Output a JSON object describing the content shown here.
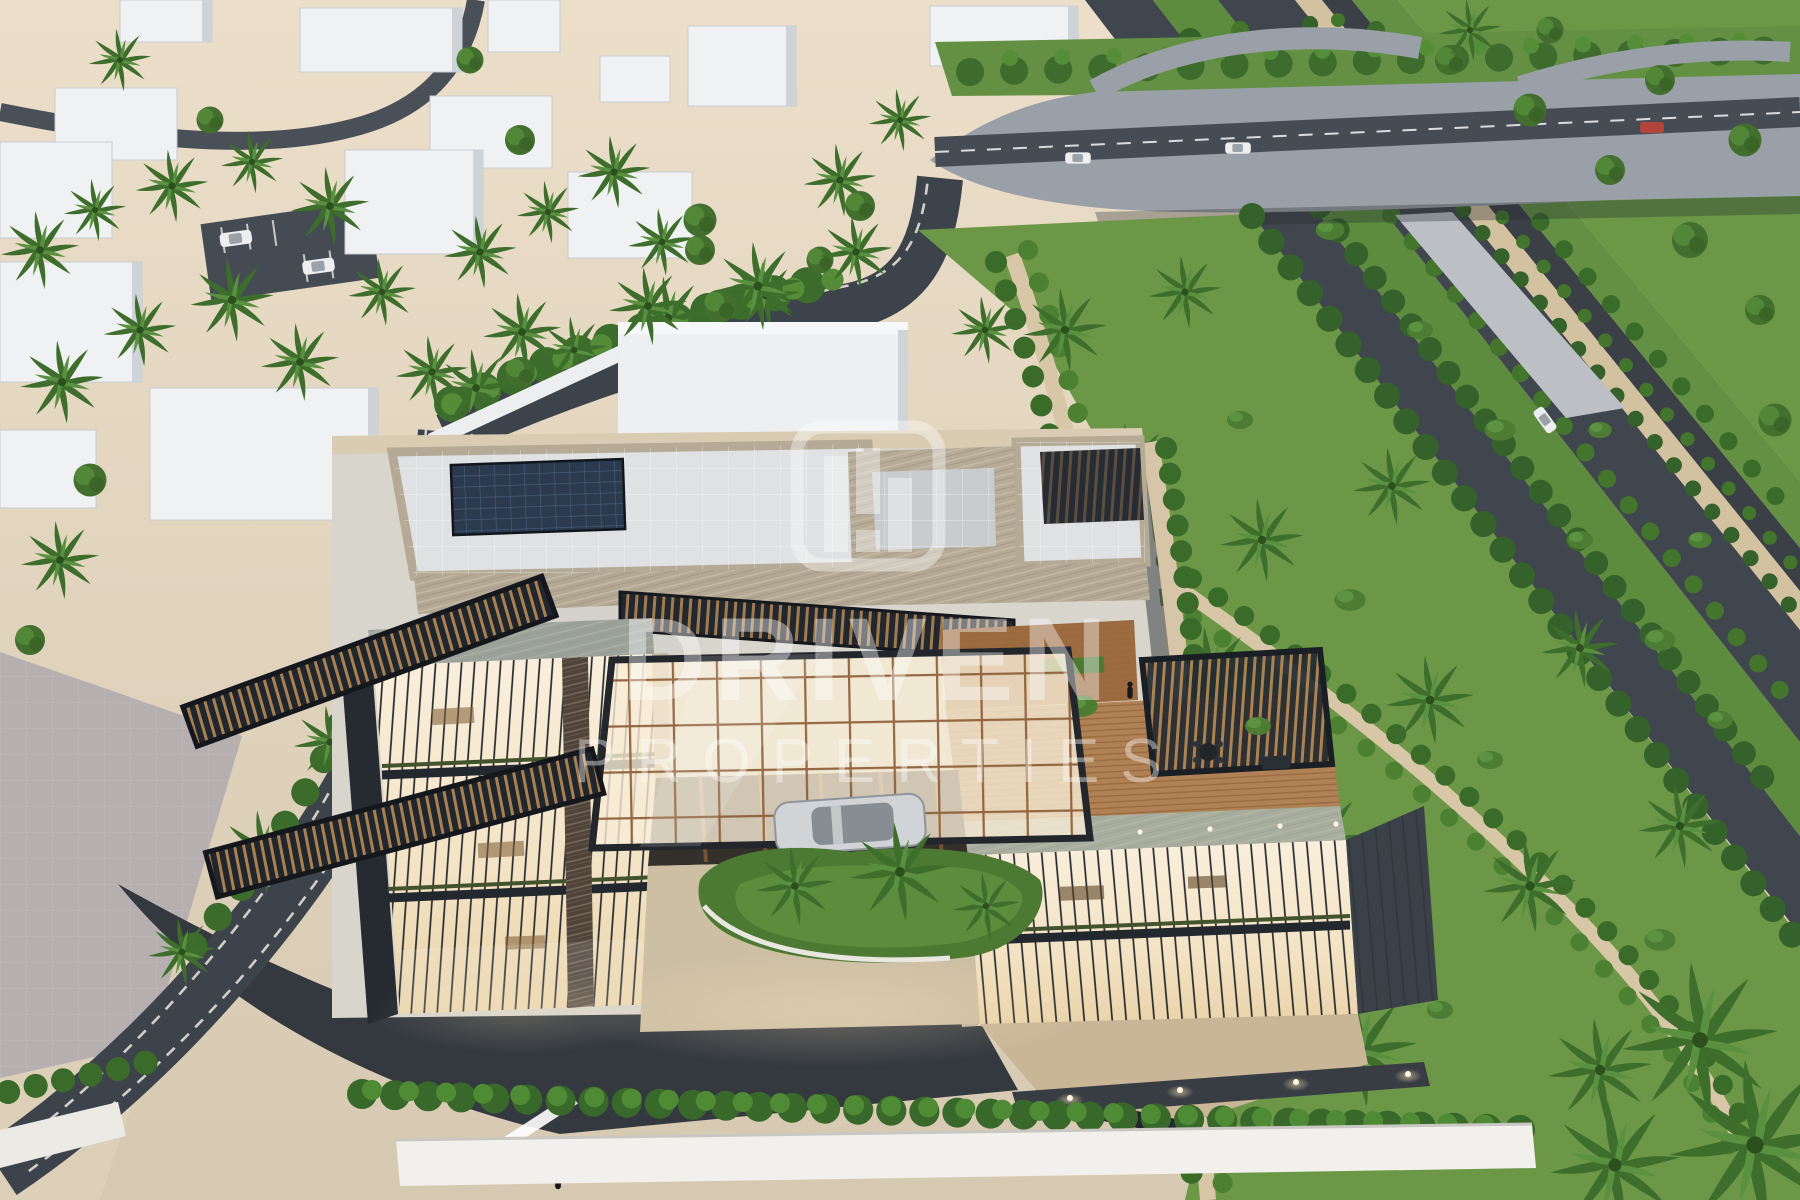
{
  "watermark": {
    "title": "DRIVEN",
    "subtitle": "PROPERTIES",
    "logo_icon": "driven-properties-bars-logo",
    "color": "#ffffff",
    "opacity": 0.4
  },
  "scene": {
    "type": "aerial-architectural-render",
    "features": [
      "desert-city-district",
      "white-context-buildings",
      "highway-interchange-overpass",
      "landscaped-highway-corridor",
      "modern-glass-villa",
      "glass-atrium-canopy",
      "rooftop-terrace-pergola",
      "solar-panel-array",
      "palm-landscaping",
      "entrance-driveway-with-car",
      "perimeter-hedge-and-wall"
    ]
  },
  "palette": {
    "sand": "#e2d6c0",
    "pavement": "#b5afb0",
    "asphalt": "#3d434a",
    "asphalt_dark": "#34393f",
    "concrete": "#9aa0a7",
    "lawn": "#6b9747",
    "lawn_dark": "#5d8c3e",
    "hedge": "#3b6b28",
    "travertine": "#b3a893",
    "stone_green": "#9aa29a",
    "glass_warm": "#f6ead2",
    "mullion": "#23272c",
    "wood": "#b08154",
    "bronze": "#8a5a33",
    "steel": "#20262c",
    "solar_panel": "#2b3a4e",
    "car_silver": "#d0d4d7",
    "white_building": "#eceef0",
    "boundary_wall": "#f1f0ec",
    "path_tan": "#d6c6a7"
  }
}
